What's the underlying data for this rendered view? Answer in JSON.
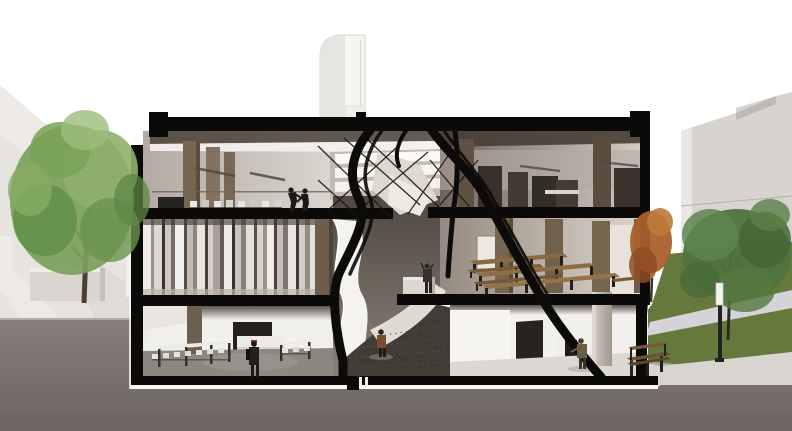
{
  "canvas": {
    "width": 792,
    "height": 431
  },
  "palette": {
    "sky": "#ffffff",
    "plaza": "#e7e3df",
    "earth": "#7e7672",
    "poche": "#0b0a09",
    "tower": "#f6f5f2",
    "neighbor_wall": "#d7d3cf",
    "lawn": "#66793c",
    "path": "#d9d8e0",
    "sidewalk": "#d8d5d1",
    "tree_green_left": "#7ba05b",
    "tree_green_right": "#4f7340",
    "tree_autumn": "#a9602c",
    "trunk": "#4e3f30",
    "wood_pier": "#77664f",
    "interior_wall_light": "#efece8",
    "ceiling_white": "#f4f2ef",
    "slat_dark": "#554e47",
    "table_wood": "#8a6a42",
    "table_white": "#eceae6",
    "floor_gray": "#8d8782",
    "atrium_wall": "#f5f3ef",
    "atrium_floor": "#413c36",
    "bench_wood": "#6b5134",
    "column_concrete": "#c9c2b8",
    "figure_dark": "#1c1a18",
    "figure_brown": "#7a4a33",
    "figure_olive": "#6b5f42"
  },
  "scene": {
    "type": "architectural sectional perspective render",
    "building": {
      "visible_floors": 3,
      "cut_material": "black poche"
    },
    "rooms": [
      "top-floor-studio",
      "top-floor-workshop",
      "slat-screen-room",
      "dining-hall",
      "ground-floor-cafeteria",
      "central-atrium",
      "ground-floor-gallery"
    ],
    "figures": [
      {
        "name": "workers-top-floor",
        "count": 2
      },
      {
        "name": "visitor-cafeteria",
        "count": 1
      },
      {
        "name": "visitor-atrium",
        "count": 1
      },
      {
        "name": "photographer-platform",
        "count": 1
      },
      {
        "name": "visitor-gallery",
        "count": 1
      }
    ],
    "trees": [
      {
        "name": "plaza-tree-left",
        "foliage": "green"
      },
      {
        "name": "courtyard-tree-autumn",
        "foliage": "orange"
      },
      {
        "name": "courtyard-tree-right",
        "foliage": "green"
      }
    ],
    "site": [
      "left-plaza",
      "planter-walls",
      "rooftop-tower",
      "right-lawn",
      "footpath",
      "street-bench",
      "lamp-post",
      "neighbor-building"
    ]
  }
}
